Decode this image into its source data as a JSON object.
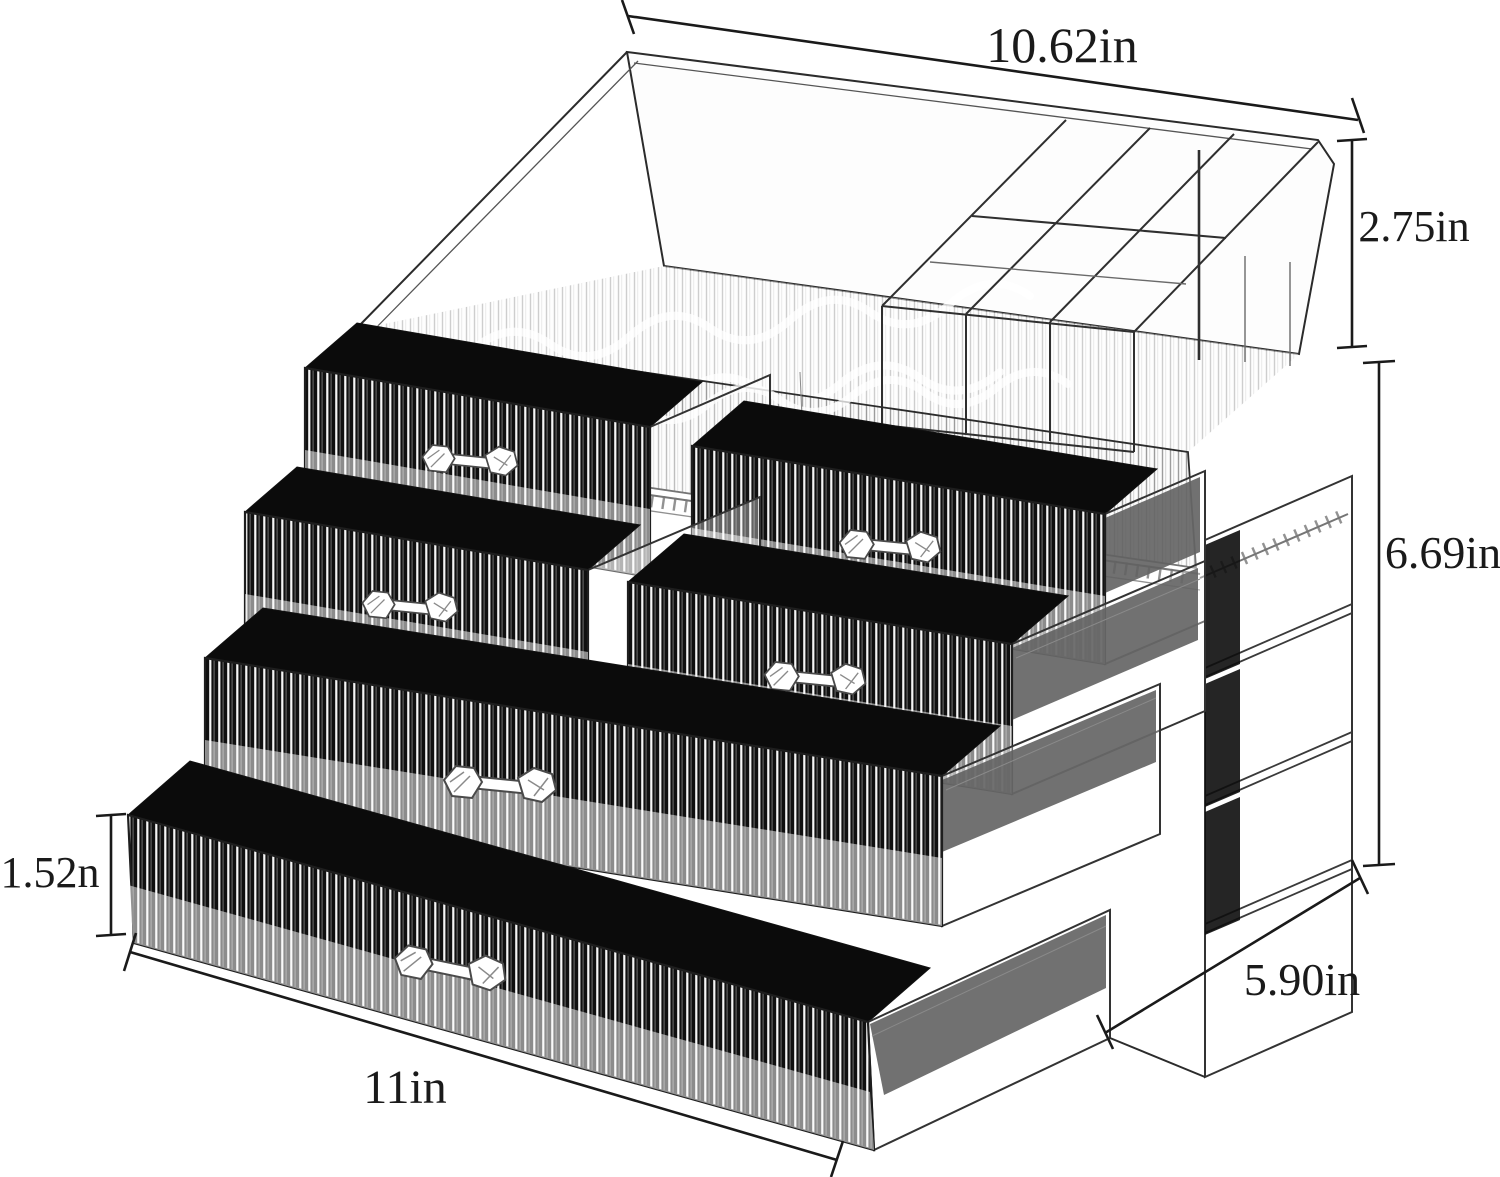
{
  "figure": {
    "description": "Clear acrylic cosmetic organizer with top lipstick tray and six pulled-out drawers, shown as a measurement diagram",
    "background_color": "#ffffff",
    "line_color": "#1a1a1a",
    "interior_color": "#0b0b0b"
  },
  "dimensions": {
    "top_width": {
      "label": "10.62in"
    },
    "top_section_height": {
      "label": "2.75in"
    },
    "drawer_section_height": {
      "label": "6.69in"
    },
    "bottom_drawer_height": {
      "label": "1.52n"
    },
    "base_width": {
      "label": "11in"
    },
    "base_depth": {
      "label": "5.90in"
    }
  }
}
